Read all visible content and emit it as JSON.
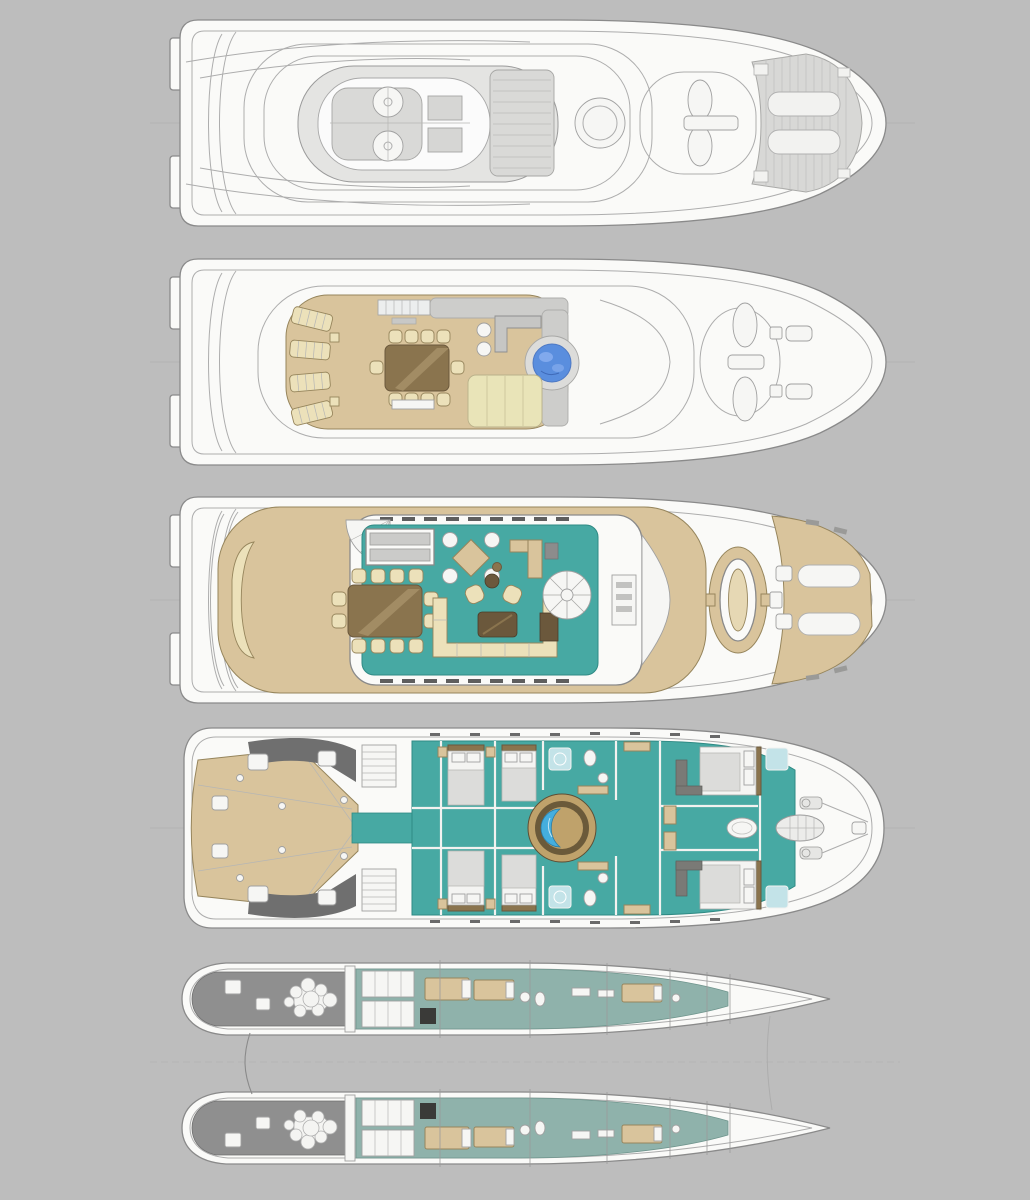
{
  "document": {
    "type": "yacht-general-arrangement-plans",
    "vessel_type": "power-catamaran",
    "views_count": 5
  },
  "colors": {
    "background": "#bdbdbd",
    "hull_white": "#fafaf8",
    "outline": "#8a8a8a",
    "outline_light": "#adadad",
    "teak": "#d9c49c",
    "teak_light": "#e6d8b4",
    "teal": "#47a9a3",
    "teal_stroke": "#2f8a84",
    "hull_teal": "#8fb2ab",
    "cream": "#ece1ba",
    "pale_pad": "#e9e4b8",
    "wood": "#8a744e",
    "wood_dark": "#6b583c",
    "wood_stroke": "#96855c",
    "jacuzzi_blue": "#5a8ede",
    "jacuzzi_light": "#85acee",
    "pool_blue": "#45aede",
    "ring_tan": "#bfa26b",
    "ring_dark": "#6b5a3a",
    "counter_gray": "#cbcbc9",
    "pad_gray": "#d9d9d7",
    "dark_gray": "#6f6f6f",
    "engine_gray": "#8f8f8f",
    "shower_blue": "#c3e3e8",
    "window_dark": "#5e5e5e",
    "centerline": "#b2b2b2"
  },
  "views": [
    {
      "id": "sun-roof-plan",
      "order": 1,
      "features": [
        "stern-steps",
        "mast-radar-platform",
        "radar-domes",
        "funnel-ring",
        "hatched-sun-pads",
        "bow-lounge-pads"
      ]
    },
    {
      "id": "flybridge-deck-plan",
      "order": 2,
      "features": [
        "teak-deck",
        "sun-loungers",
        "al-fresco-dining-table",
        "wet-bar",
        "bar-stools",
        "jacuzzi",
        "sun-pads",
        "bow-bench-seating"
      ],
      "counts": {
        "sun_loungers": 4,
        "dining_seats": 10,
        "bar_stools": 2,
        "jacuzzis": 1
      }
    },
    {
      "id": "main-deck-plan",
      "order": 3,
      "features": [
        "aft-deck-curved-sofa",
        "salon",
        "dining-table",
        "u-shaped-sofa",
        "coffee-table",
        "armchairs",
        "games-table",
        "galley-counters",
        "spiral-staircase",
        "helm-console",
        "bow-oval-seat",
        "bow-sun-beds"
      ],
      "counts": {
        "dining_seats": 12,
        "games_chairs": 4
      }
    },
    {
      "id": "lower-deck-plan",
      "order": 4,
      "features": [
        "beach-club-teak-platform",
        "twin-staircases",
        "guest-cabins",
        "en-suite-bathrooms",
        "central-atrium-plunge-pool",
        "vip-cabins",
        "anchor-windlass"
      ],
      "counts": {
        "guest_cabins": 4,
        "vip_cabins": 2,
        "plunge_pools": 1
      }
    },
    {
      "id": "hulls-plan",
      "order": 5,
      "features": [
        "port-hull",
        "starboard-hull",
        "engine-rooms",
        "engine-blocks",
        "crew-quarters",
        "cross-brace-lines",
        "waterline-centerline"
      ],
      "counts": {
        "hulls": 2,
        "engine_rooms": 2
      }
    }
  ]
}
